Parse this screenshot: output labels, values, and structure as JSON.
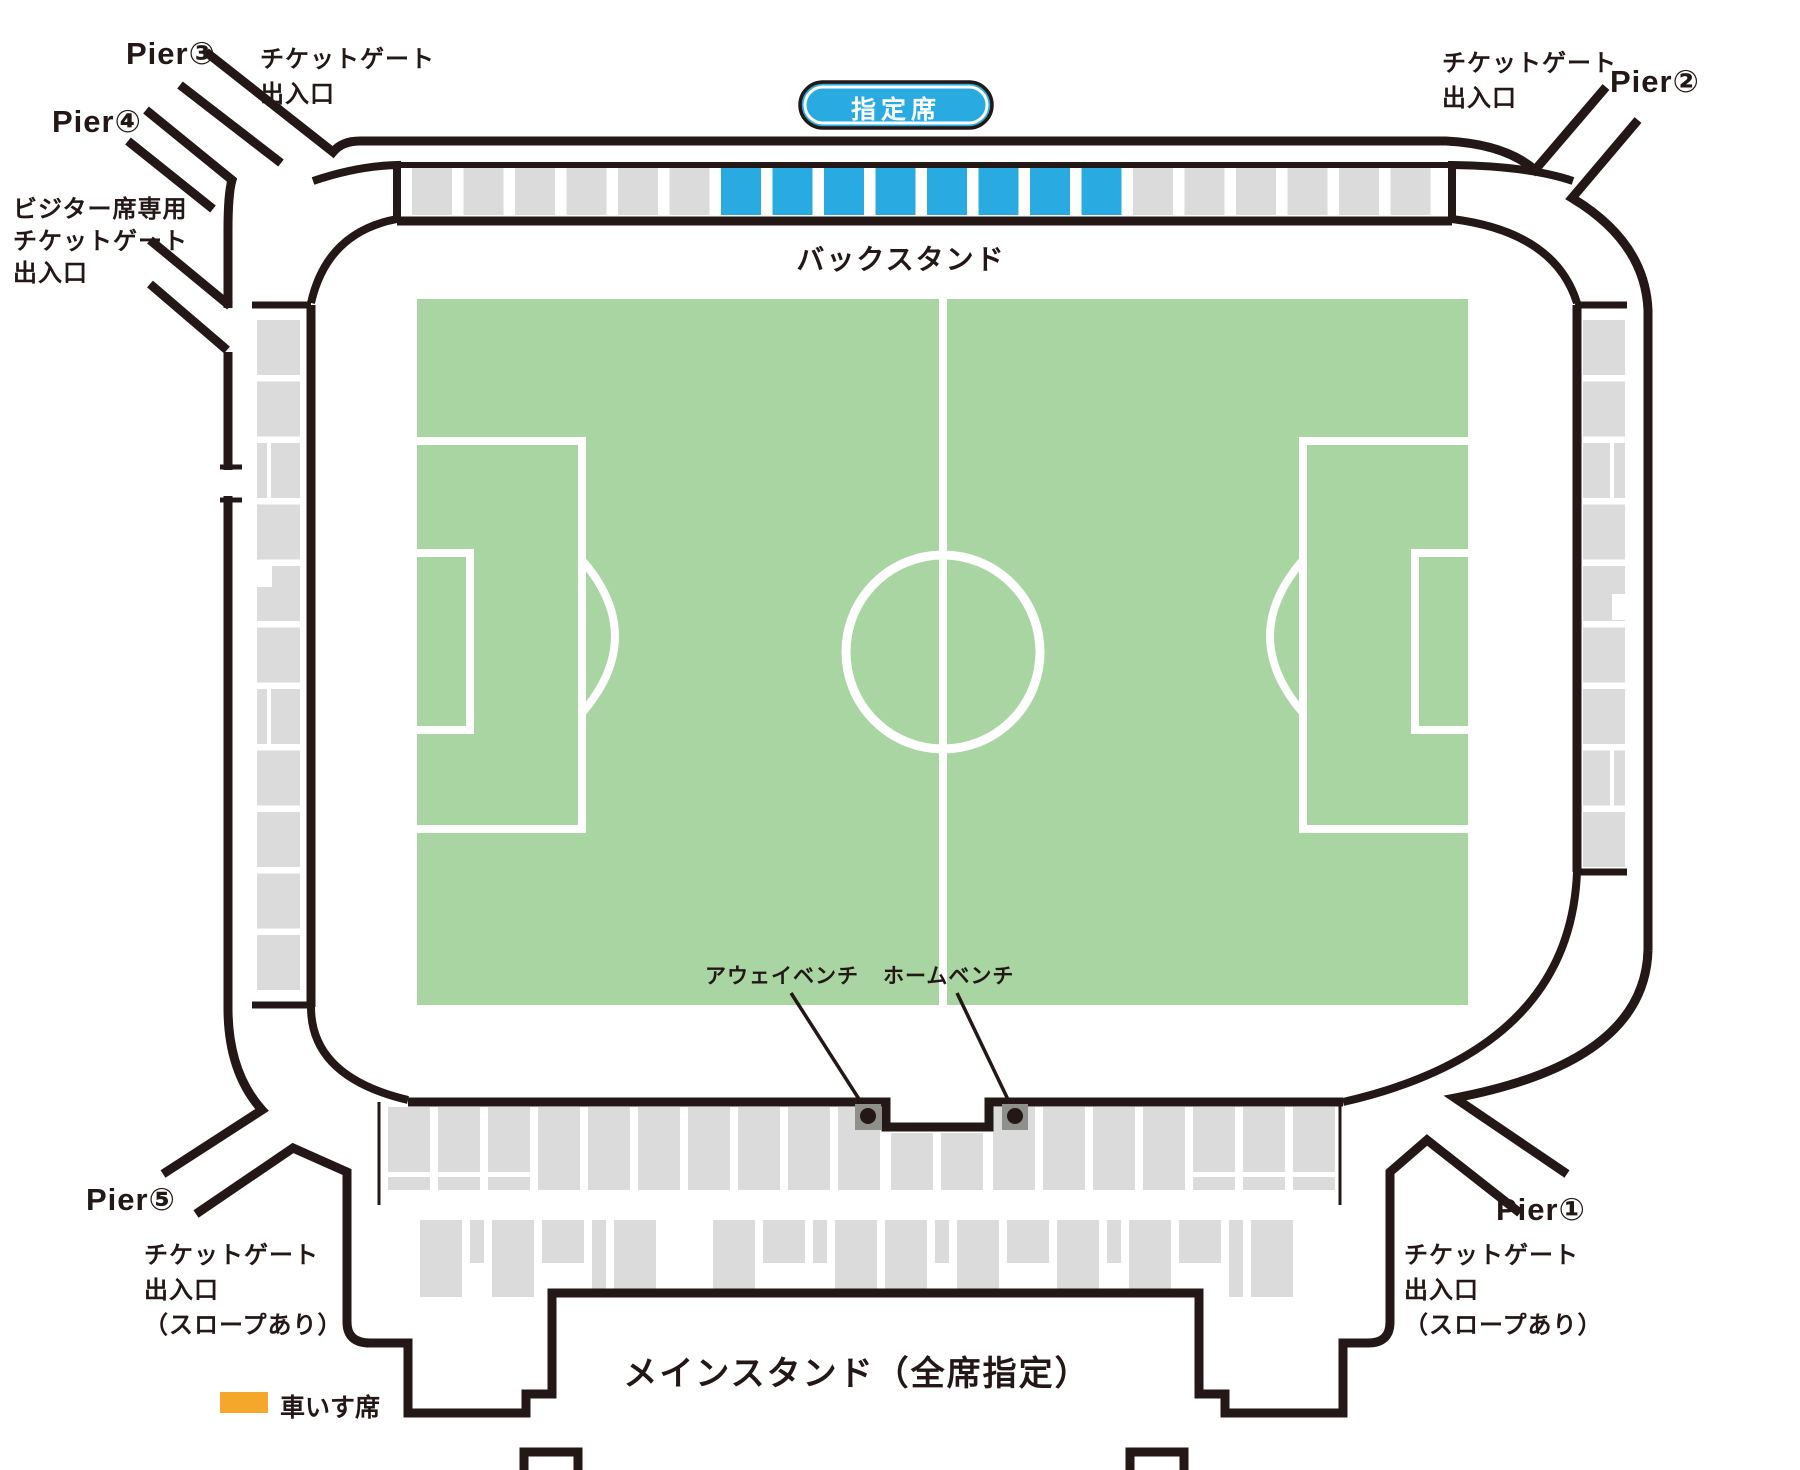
{
  "title": "スタジアム座席図",
  "colors": {
    "line": "#231815",
    "blue": "#29ABE2",
    "gray": "#DBDBDB",
    "green": "#A8D5A2",
    "orange": "#F5A72B",
    "bench_gray": "#8F8F8B",
    "white": "#FFFFFF"
  },
  "badge": {
    "label": "指定席"
  },
  "stands": {
    "back": {
      "label": "バックスタンド"
    },
    "main": {
      "label": "メインスタンド（全席指定）"
    }
  },
  "benches": {
    "away": "アウェイベンチ",
    "home": "ホームベンチ"
  },
  "legend": {
    "wheelchair": "車いす席"
  },
  "gates": {
    "top_left": {
      "pier": "Pier③",
      "lines": [
        "チケットゲート",
        "出入口"
      ]
    },
    "left_upper": {
      "pier": "Pier④",
      "lines": [
        "ビジター席専用",
        "チケットゲート",
        "出入口"
      ]
    },
    "top_right": {
      "pier": "Pier②",
      "lines": [
        "チケットゲート",
        "出入口"
      ]
    },
    "bottom_right": {
      "pier": "Pier①",
      "lines": [
        "チケットゲート",
        "出入口",
        "（スロープあり）"
      ]
    },
    "bottom_left": {
      "pier": "Pier⑤",
      "lines": [
        "チケットゲート",
        "出入口",
        "（スロープあり）"
      ]
    }
  },
  "seat_blocks": {
    "top_band": [
      "g",
      "g",
      "g",
      "g",
      "g",
      "g",
      "b",
      "b",
      "b",
      "b",
      "b",
      "b",
      "b",
      "b",
      "g",
      "g",
      "g",
      "g",
      "g",
      "g"
    ],
    "left_column": [
      "p",
      "p",
      "s",
      "p",
      "n",
      "p",
      "s",
      "p",
      "p",
      "p",
      "p"
    ],
    "right_column": [
      "p",
      "p",
      "s",
      "p",
      "n",
      "p",
      "p",
      "s",
      "p"
    ],
    "bottom_row1": [
      {
        "x": 388,
        "v": "s"
      },
      {
        "x": 438,
        "v": "s"
      },
      {
        "x": 488,
        "v": "s"
      },
      {
        "x": 538,
        "v": "f"
      },
      {
        "x": 588,
        "v": "f"
      },
      {
        "x": 638,
        "v": "f"
      },
      {
        "x": 688,
        "v": "f"
      },
      {
        "x": 738,
        "v": "f"
      },
      {
        "x": 788,
        "v": "f"
      },
      {
        "x": 838,
        "v": "f"
      },
      {
        "x": 891,
        "v": "h"
      },
      {
        "x": 941,
        "v": "h"
      },
      {
        "x": 993,
        "v": "f"
      },
      {
        "x": 1043,
        "v": "f"
      },
      {
        "x": 1093,
        "v": "f"
      },
      {
        "x": 1143,
        "v": "f"
      },
      {
        "x": 1193,
        "v": "s"
      },
      {
        "x": 1243,
        "v": "s"
      },
      {
        "x": 1293,
        "v": "s"
      }
    ],
    "bottom_row2": [
      {
        "x": 420,
        "w": 42,
        "h": 77
      },
      {
        "x": 470,
        "w": 14,
        "h": 43
      },
      {
        "x": 492,
        "w": 42,
        "h": 77
      },
      {
        "x": 542,
        "w": 42,
        "h": 43
      },
      {
        "x": 592,
        "w": 14,
        "h": 77
      },
      {
        "x": 614,
        "w": 42,
        "h": 77
      },
      {
        "x": 713,
        "w": 42,
        "h": 77
      },
      {
        "x": 763,
        "w": 42,
        "h": 43
      },
      {
        "x": 813,
        "w": 14,
        "h": 43
      },
      {
        "x": 835,
        "w": 42,
        "h": 77
      },
      {
        "x": 885,
        "w": 42,
        "h": 77
      },
      {
        "x": 935,
        "w": 14,
        "h": 43
      },
      {
        "x": 957,
        "w": 42,
        "h": 77
      },
      {
        "x": 1007,
        "w": 42,
        "h": 43
      },
      {
        "x": 1057,
        "w": 42,
        "h": 77
      },
      {
        "x": 1107,
        "w": 14,
        "h": 43
      },
      {
        "x": 1129,
        "w": 42,
        "h": 77
      },
      {
        "x": 1179,
        "w": 42,
        "h": 43
      },
      {
        "x": 1229,
        "w": 14,
        "h": 77
      },
      {
        "x": 1251,
        "w": 42,
        "h": 77
      }
    ]
  }
}
